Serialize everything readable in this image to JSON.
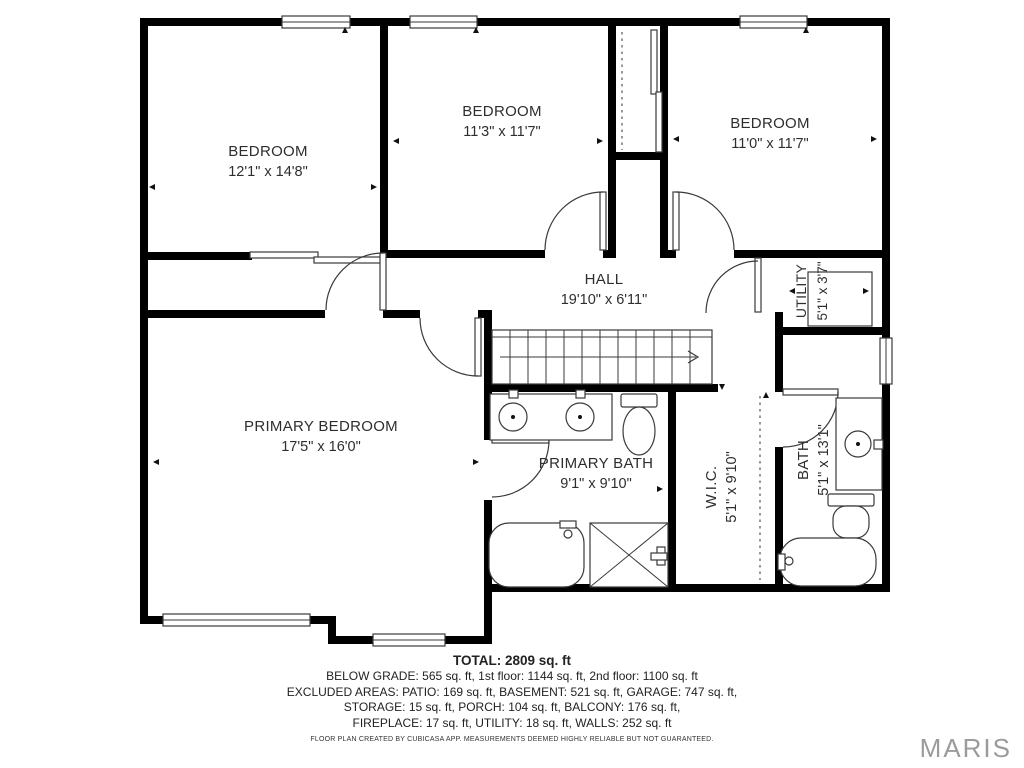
{
  "rooms": {
    "bedroom1": {
      "name": "BEDROOM",
      "dims": "12'1\" x 14'8\""
    },
    "bedroom2": {
      "name": "BEDROOM",
      "dims": "11'3\" x 11'7\""
    },
    "bedroom3": {
      "name": "BEDROOM",
      "dims": "11'0\" x 11'7\""
    },
    "hall": {
      "name": "HALL",
      "dims": "19'10\" x 6'11\""
    },
    "primary_bedroom": {
      "name": "PRIMARY BEDROOM",
      "dims": "17'5\" x 16'0\""
    },
    "primary_bath": {
      "name": "PRIMARY BATH",
      "dims": "9'1\" x 9'10\""
    },
    "wic": {
      "name": "W.I.C.",
      "dims": "5'1\" x 9'10\""
    },
    "bath": {
      "name": "BATH",
      "dims": "5'1\" x 13'1\""
    },
    "utility": {
      "name": "UTILITY",
      "dims": "5'1\" x 3'7\""
    }
  },
  "summary": {
    "total": "TOTAL: 2809 sq. ft",
    "line1": "BELOW GRADE: 565 sq. ft, 1st floor: 1144 sq. ft, 2nd floor: 1100 sq. ft",
    "line2": "EXCLUDED AREAS: PATIO: 169 sq. ft, BASEMENT: 521 sq. ft, GARAGE: 747 sq. ft,",
    "line3": "STORAGE: 15 sq. ft, PORCH: 104 sq. ft, BALCONY: 176 sq. ft,",
    "line4": "FIREPLACE: 17 sq. ft, UTILITY: 18 sq. ft, WALLS: 252 sq. ft",
    "disclaimer": "FLOOR PLAN CREATED BY CUBICASA APP. MEASUREMENTS DEEMED HIGHLY RELIABLE BUT NOT GUARANTEED."
  },
  "watermark": "MARIS",
  "colors": {
    "wall": "#000000",
    "fixture_line": "#3a3a3a",
    "label_text": "#2e2e2e",
    "watermark": "#9b9b9b",
    "background": "#ffffff"
  }
}
